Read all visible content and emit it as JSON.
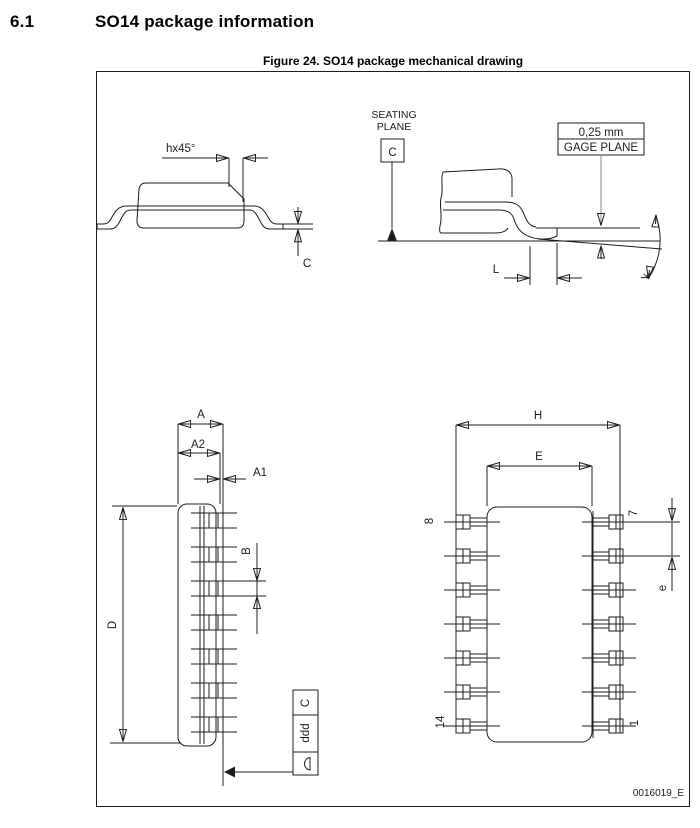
{
  "page": {
    "section_number": "6.1",
    "section_title": "SO14 package information",
    "figure_caption": "Figure 24. SO14 package mechanical drawing",
    "drawing_code": "0016019_E"
  },
  "labels": {
    "chamfer": "hx45°",
    "lead_thickness": "C",
    "seating_line1": "SEATING",
    "seating_line2": "PLANE",
    "datum_c": "C",
    "gage_value": "0,25 mm",
    "gage_name": "GAGE PLANE",
    "foot_length": "L",
    "foot_angle": "k",
    "dim_A": "A",
    "dim_A2": "A2",
    "dim_A1": "A1",
    "dim_B": "B",
    "dim_D": "D",
    "tol_datum": "C",
    "tol_value": "ddd",
    "dim_H": "H",
    "dim_E": "E",
    "dim_e": "e",
    "pin8": "8",
    "pin7": "7",
    "pin14": "14",
    "pin1": "1"
  },
  "colors": {
    "line": "#1c1c1c",
    "background": "#ffffff"
  }
}
